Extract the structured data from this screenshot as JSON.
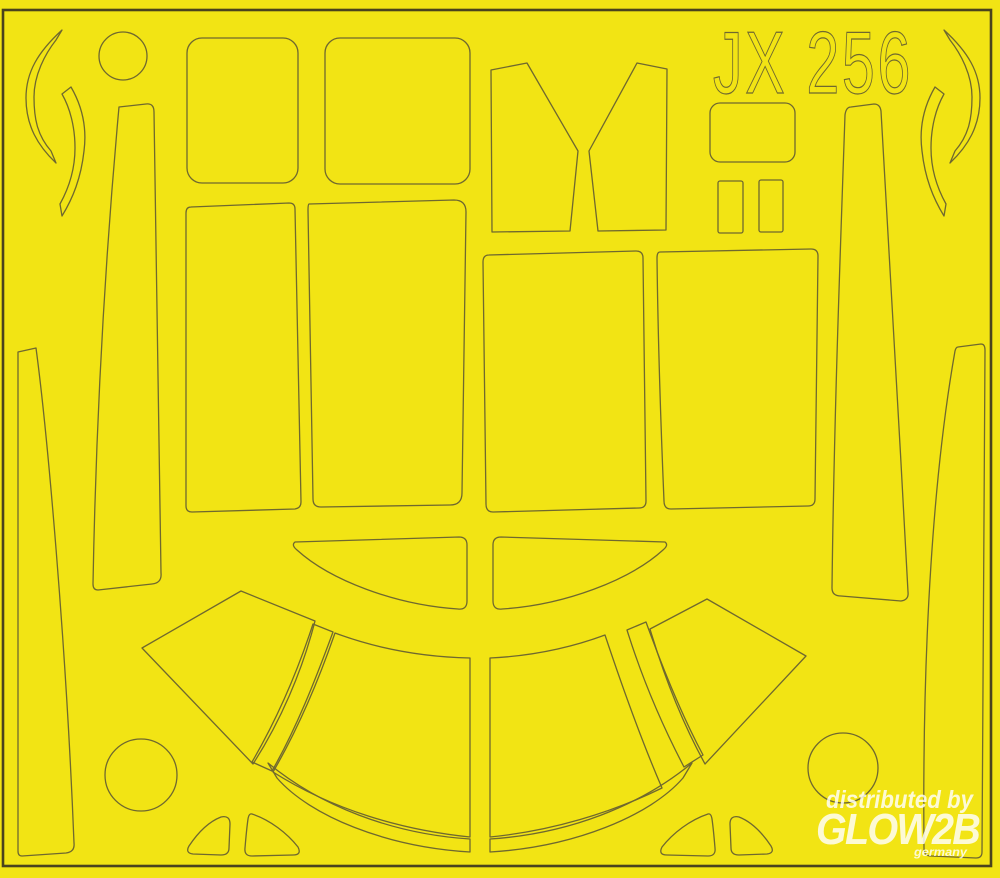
{
  "sheet": {
    "product_code": "JX 256",
    "description": "yellow die-cut paint mask sheet with cut outlines"
  },
  "watermark": {
    "distributor_line": "distributed by",
    "brand": "GLOW2B",
    "brand_sub": "germany"
  },
  "colors": {
    "sheet_yellow": "#f2e414",
    "cut_line": "#6f682f",
    "frame_line": "#4a431d",
    "watermark_white": "#ffffff"
  },
  "pieces": [
    "crescent-left-outer",
    "crescent-left-inner",
    "circle-top-left",
    "strip-left-tall",
    "strip-far-left",
    "square-top-1",
    "square-top-2",
    "windscreen-left-half",
    "windscreen-right-half",
    "small-rounded-rect",
    "small-rect-1",
    "small-rect-2",
    "crescent-right-outer",
    "crescent-right-inner",
    "strip-right-tall",
    "strip-far-right",
    "rect-large-1",
    "rect-large-2",
    "rect-large-3",
    "rect-large-4",
    "eyebrow-left",
    "eyebrow-right",
    "wedge-left",
    "pillar-left",
    "segment-center-left",
    "segment-center-right",
    "pillar-right",
    "wedge-right",
    "thin-arc-left",
    "thin-arc-right",
    "circle-bottom-left",
    "circle-bottom-right",
    "foot-1",
    "foot-2",
    "foot-3",
    "foot-4"
  ]
}
